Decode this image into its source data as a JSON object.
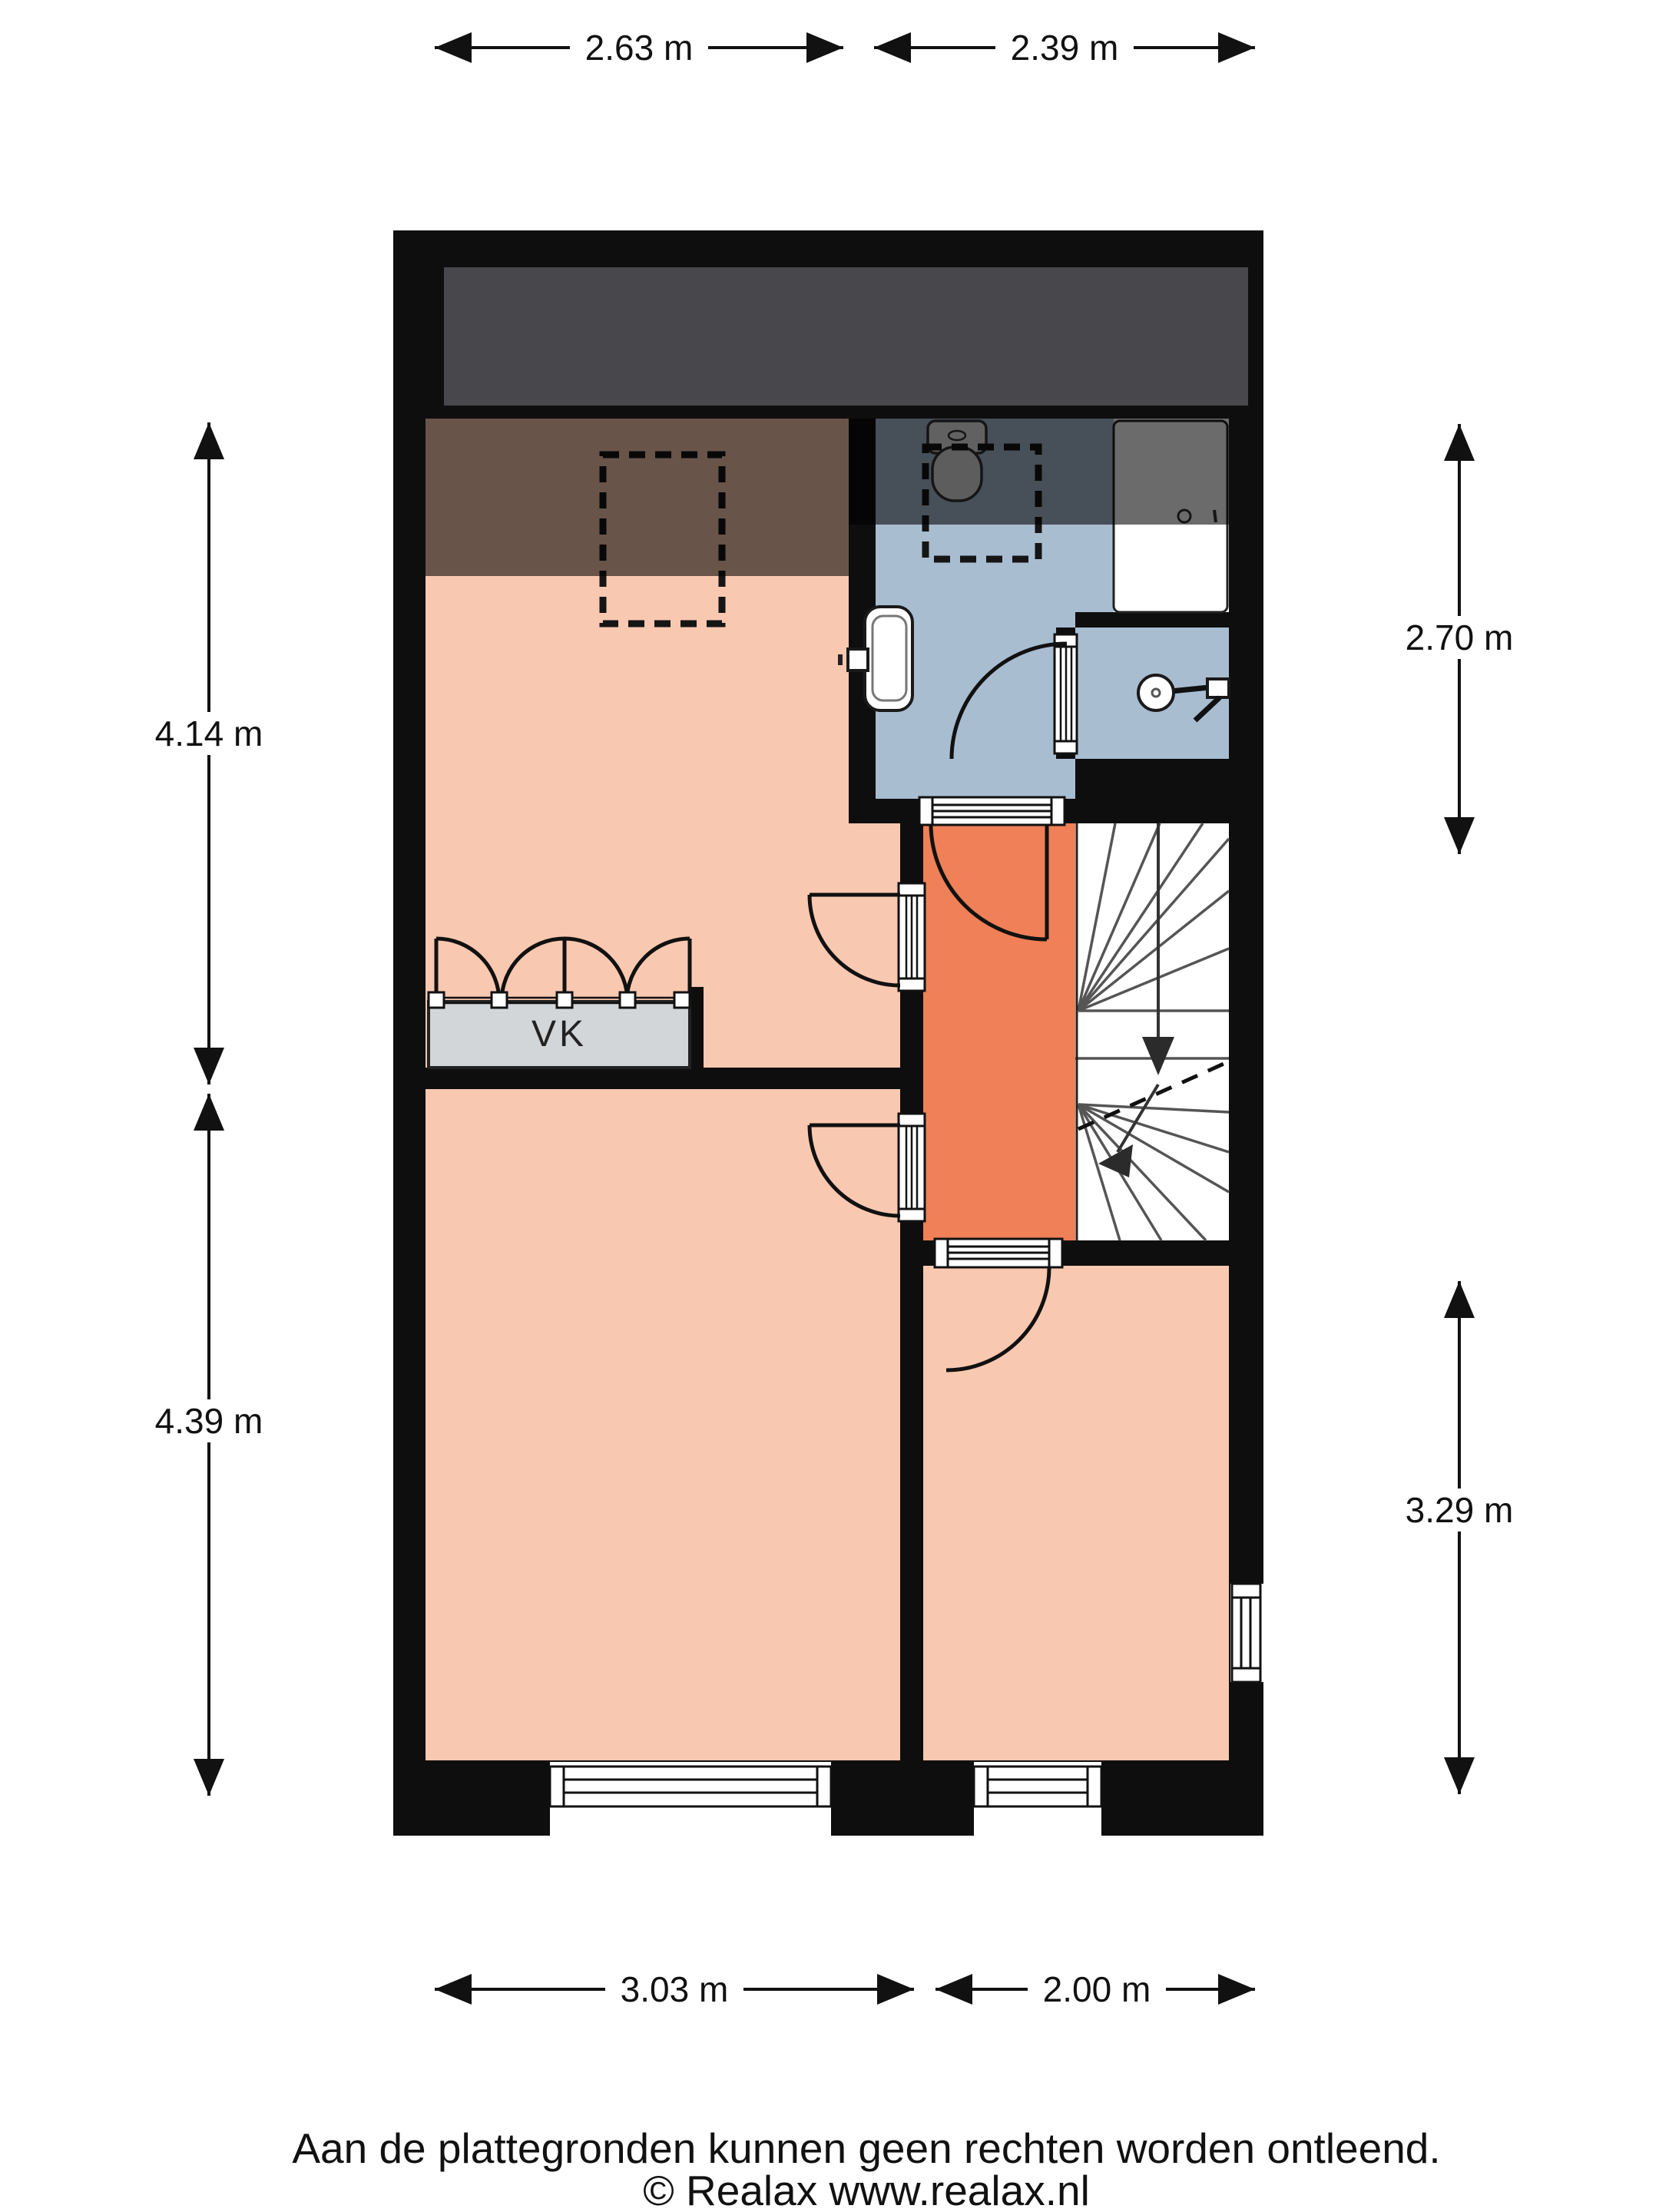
{
  "title": "Plattegrond begane grond",
  "dims": {
    "top_left": {
      "label": "2.63 m"
    },
    "top_right": {
      "label": "2.39 m"
    },
    "left_upper": {
      "label": "4.14 m"
    },
    "left_lower": {
      "label": "4.39 m"
    },
    "right_upper": {
      "label": "2.70 m"
    },
    "right_lower": {
      "label": "3.29 m"
    },
    "bottom_left": {
      "label": "3.03 m"
    },
    "bottom_right": {
      "label": "2.00 m"
    }
  },
  "labels": {
    "closet": "VK"
  },
  "footer": {
    "disclaimer": "Aan de plattegronden kunnen geen rechten worden ontleend.",
    "copyright": "© Realax www.realax.nl"
  },
  "colors": {
    "salmon": "#f9c8b0",
    "hall": "#ef8057",
    "bath": "#a9bdd1",
    "closet": "#d2d6d9",
    "attic": "#48484c",
    "wall": "#0e0e0e",
    "line": "#111111"
  }
}
